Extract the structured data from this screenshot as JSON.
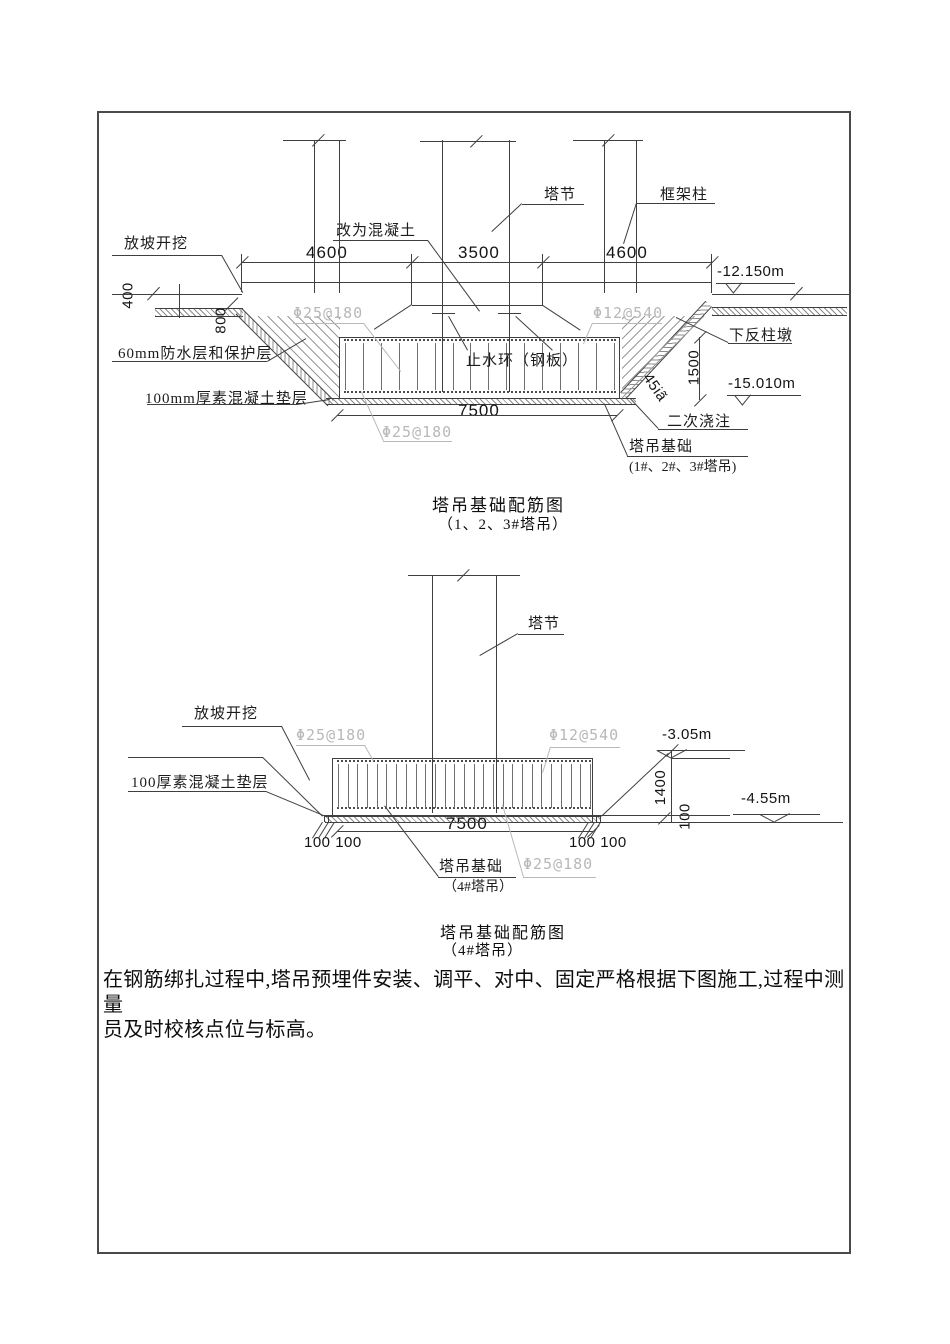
{
  "d1": {
    "slope_excavation": "放坡开挖",
    "changed_concrete": "改为混凝土",
    "tower_section": "塔节",
    "frame_column": "框架柱",
    "dim_4600_left": "4600",
    "dim_3500": "3500",
    "dim_4600_right": "4600",
    "level_top": "-12.150m",
    "rebar_top": "Φ25@180",
    "rebar_distribution": "Φ12@540",
    "rebar_bottom": "Φ25@180",
    "down_pier": "下反柱墩",
    "waterproof_layer": "60mm防水层和保护层",
    "waterstop_ring": "止水环（钢板）",
    "blinding_layer": "100mm厚素混凝土垫层",
    "dim_400": "400",
    "dim_800": "800",
    "dim_1500": "1500",
    "angle": "45iã",
    "level_bottom": "-15.010m",
    "dim_7500": "7500",
    "secondary_pour": "二次浇注",
    "foundation_label": "塔吊基础",
    "foundation_tags": "(1#、2#、3#塔吊)",
    "title": "塔吊基础配筋图",
    "subtitle": "（1、2、3#塔吊）"
  },
  "d2": {
    "tower_section": "塔节",
    "slope_excavation": "放坡开挖",
    "rebar_top": "Φ25@180",
    "rebar_distribution": "Φ12@540",
    "rebar_bottom": "Φ25@180",
    "level_top": "-3.05m",
    "level_bottom": "-4.55m",
    "blinding_layer": "100厚素混凝土垫层",
    "dim_7500": "7500",
    "dim_1400": "1400",
    "dim_100": "100",
    "dim_100_100_left": "100 100",
    "dim_100_100_right": "100 100",
    "foundation_label": "塔吊基础",
    "foundation_tag": "（4#塔吊）",
    "title": "塔吊基础配筋图",
    "subtitle": "（4#塔吊）"
  },
  "note": {
    "line1": "在钢筋绑扎过程中,塔吊预埋件安装、调平、对中、固定严格根据下图施工,过程中测量",
    "line2": "员及时校核点位与标高。"
  }
}
